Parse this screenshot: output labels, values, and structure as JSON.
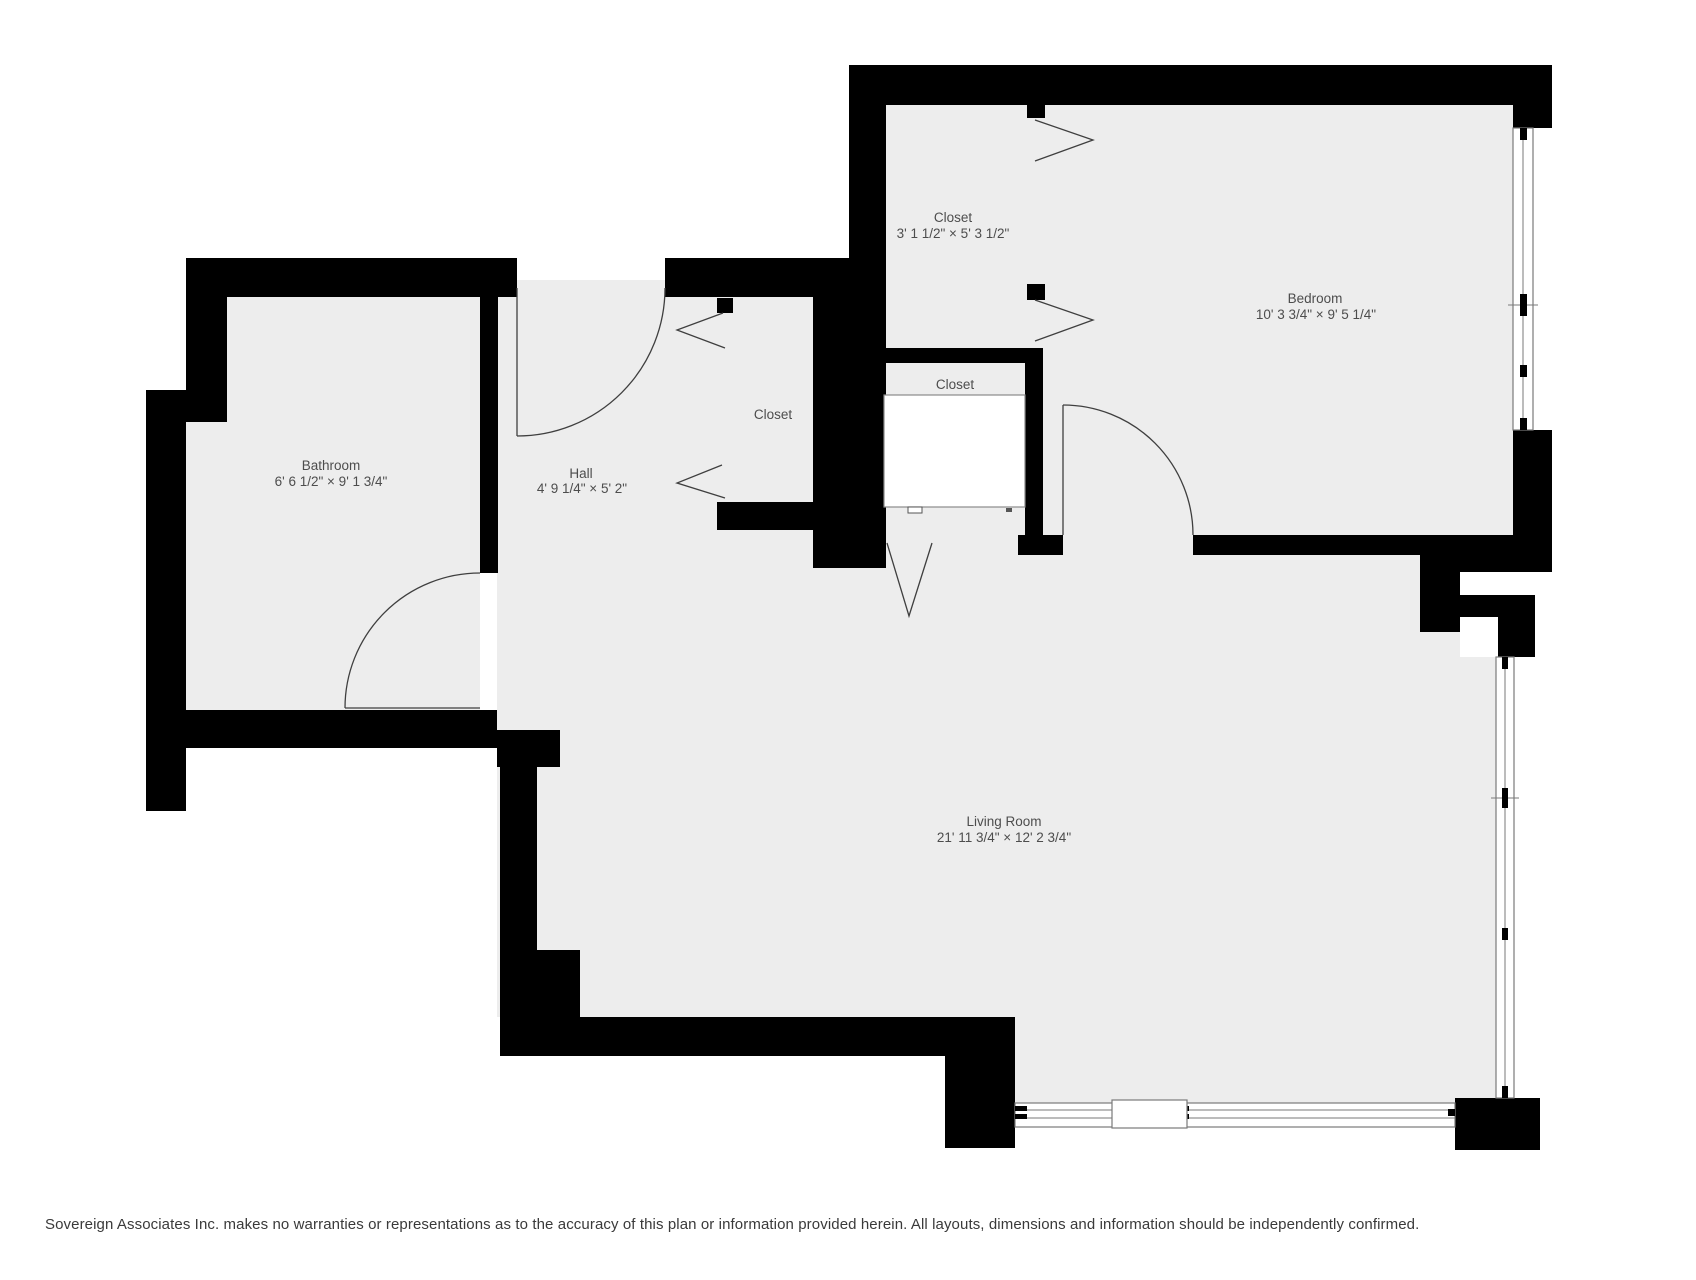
{
  "floorplan": {
    "rooms": [
      {
        "id": "closet-top",
        "name": "Closet",
        "dimensions": "3' 1 1/2\" × 5' 3 1/2\""
      },
      {
        "id": "bedroom",
        "name": "Bedroom",
        "dimensions": "10' 3 3/4\" × 9' 5 1/4\""
      },
      {
        "id": "bathroom",
        "name": "Bathroom",
        "dimensions": "6' 6 1/2\" × 9' 1 3/4\""
      },
      {
        "id": "hall",
        "name": "Hall",
        "dimensions": "4' 9 1/4\" × 5' 2\""
      },
      {
        "id": "closet-hall",
        "name": "Closet",
        "dimensions": ""
      },
      {
        "id": "closet-entry",
        "name": "Closet",
        "dimensions": ""
      },
      {
        "id": "living-room",
        "name": "Living Room",
        "dimensions": "21' 11 3/4\" × 12' 2 3/4\""
      }
    ],
    "colors": {
      "wall": "#000000",
      "floor": "#ededed",
      "line": "#3f3f3f",
      "label": "#4d4d4d"
    },
    "footer": {
      "disclaimer": "Sovereign Associates Inc. makes no warranties or representations as to the accuracy of this plan or information provided herein. All layouts, dimensions and information should be independently confirmed."
    }
  }
}
